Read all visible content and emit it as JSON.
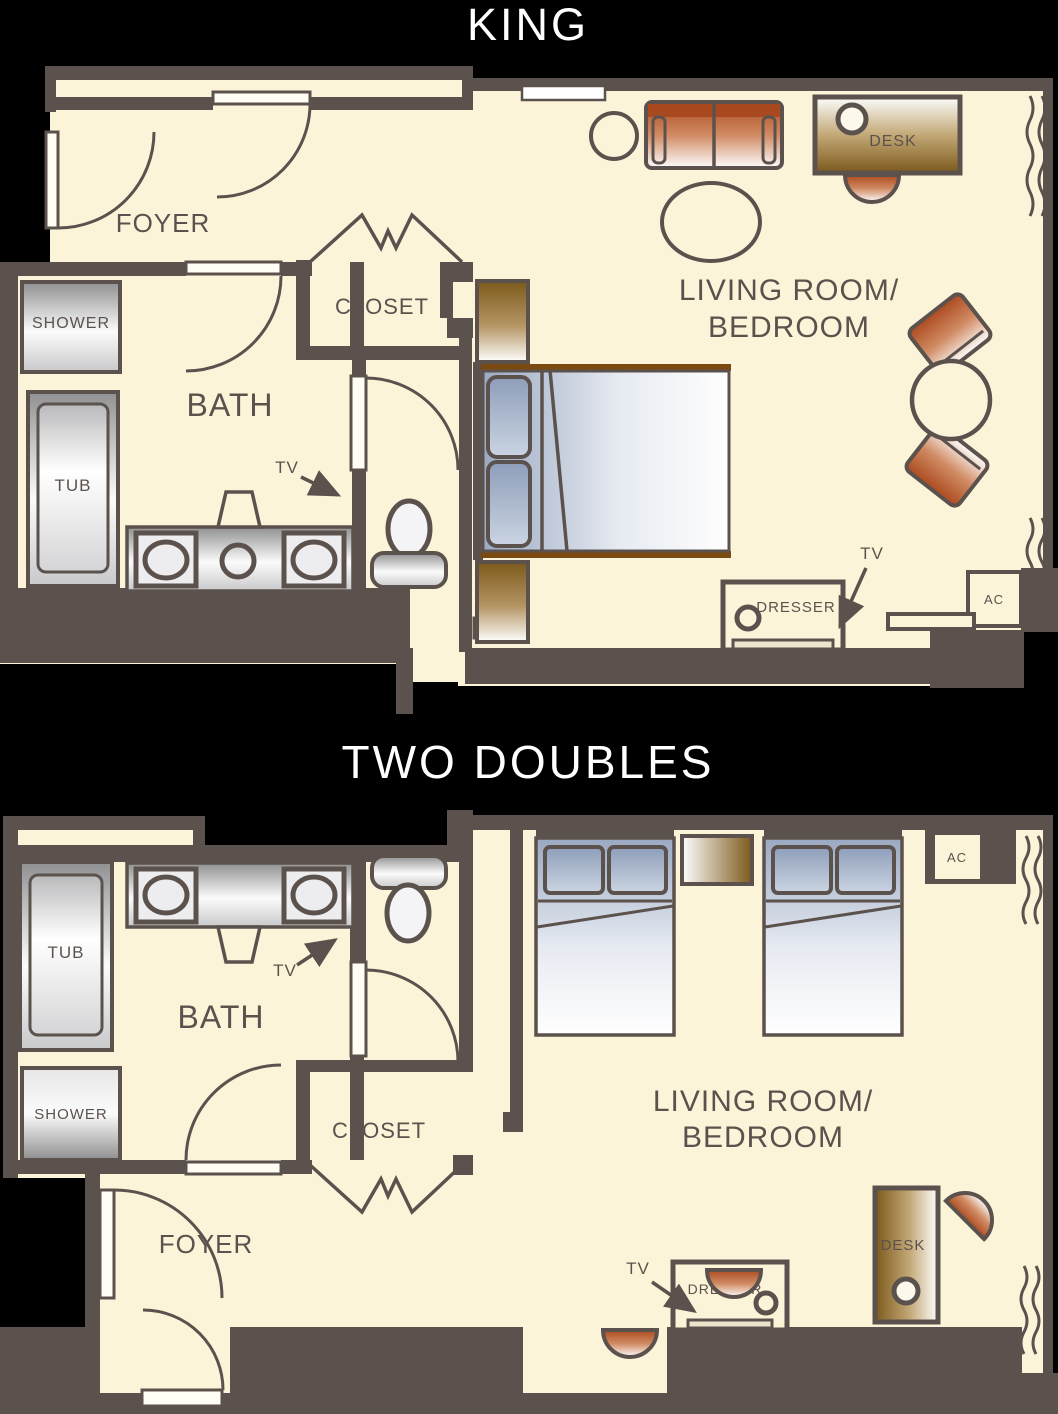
{
  "colors": {
    "background": "#000000",
    "floor": "#FCF4D9",
    "wall": "#5C524D",
    "accent_orange": "#B04B22",
    "accent_brown": "#7C591B",
    "bed_blue": "#9AA9C2",
    "metal_gray": "#909092",
    "bed_frame_brown": "#7A4A10",
    "title_text": "#FFFFFF",
    "label_text": "#5C524D"
  },
  "plans": {
    "king": {
      "title": "KING",
      "labels": {
        "foyer": "FOYER",
        "closet": "CLOSET",
        "bath": "BATH",
        "living1": "LIVING ROOM/",
        "living2": "BEDROOM",
        "shower": "SHOWER",
        "tub": "TUB",
        "tv_bath": "TV",
        "tv_bedroom": "TV",
        "desk": "DESK",
        "dresser": "DRESSER",
        "ac": "AC"
      }
    },
    "two_doubles": {
      "title": "TWO DOUBLES",
      "labels": {
        "foyer": "FOYER",
        "closet": "CLOSET",
        "bath": "BATH",
        "living1": "LIVING ROOM/",
        "living2": "BEDROOM",
        "shower": "SHOWER",
        "tub": "TUB",
        "tv_bath": "TV",
        "tv_dresser": "TV",
        "desk": "DESK",
        "dresser": "DRESSER",
        "ac": "AC"
      }
    }
  }
}
